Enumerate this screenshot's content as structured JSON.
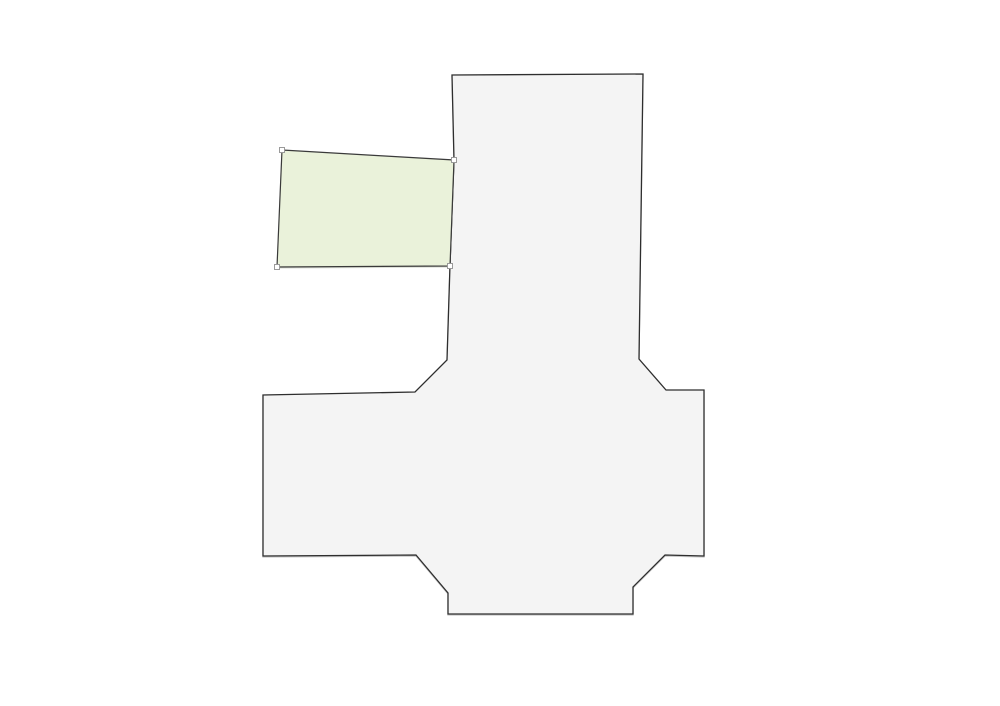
{
  "canvas": {
    "width": 1000,
    "height": 706,
    "background_color": "#ffffff",
    "shapes": [
      {
        "id": "parcel-outline",
        "role": "building-footprint-polygon",
        "type": "polygon",
        "fill": "#f4f4f4",
        "stroke": "#2e2e2e",
        "stroke_width": 1.3,
        "css_class": "shape-main",
        "interactable": true,
        "handles": false,
        "points": [
          [
            452,
            75
          ],
          [
            643,
            74
          ],
          [
            639,
            359
          ],
          [
            666,
            390
          ],
          [
            704,
            390
          ],
          [
            704,
            556
          ],
          [
            665,
            555
          ],
          [
            633,
            587
          ],
          [
            633,
            614
          ],
          [
            448,
            614
          ],
          [
            448,
            593
          ],
          [
            416,
            555
          ],
          [
            263,
            556
          ],
          [
            263,
            395
          ],
          [
            415,
            392
          ],
          [
            447,
            360
          ],
          [
            450,
            265
          ],
          [
            454,
            160
          ]
        ]
      },
      {
        "id": "selected-parcel",
        "role": "selected-editable-polygon",
        "type": "polygon",
        "fill": "#eaf2da",
        "stroke": "#3a3a3a",
        "stroke_width": 1.2,
        "css_class": "shape-selected",
        "interactable": true,
        "handles": true,
        "points": [
          [
            282,
            150
          ],
          [
            454,
            160
          ],
          [
            450,
            266
          ],
          [
            277,
            267
          ]
        ]
      }
    ],
    "handle_style": {
      "size": 5,
      "fill": "#ffffff",
      "stroke": "#9a9a9a",
      "stroke_width": 1
    }
  }
}
